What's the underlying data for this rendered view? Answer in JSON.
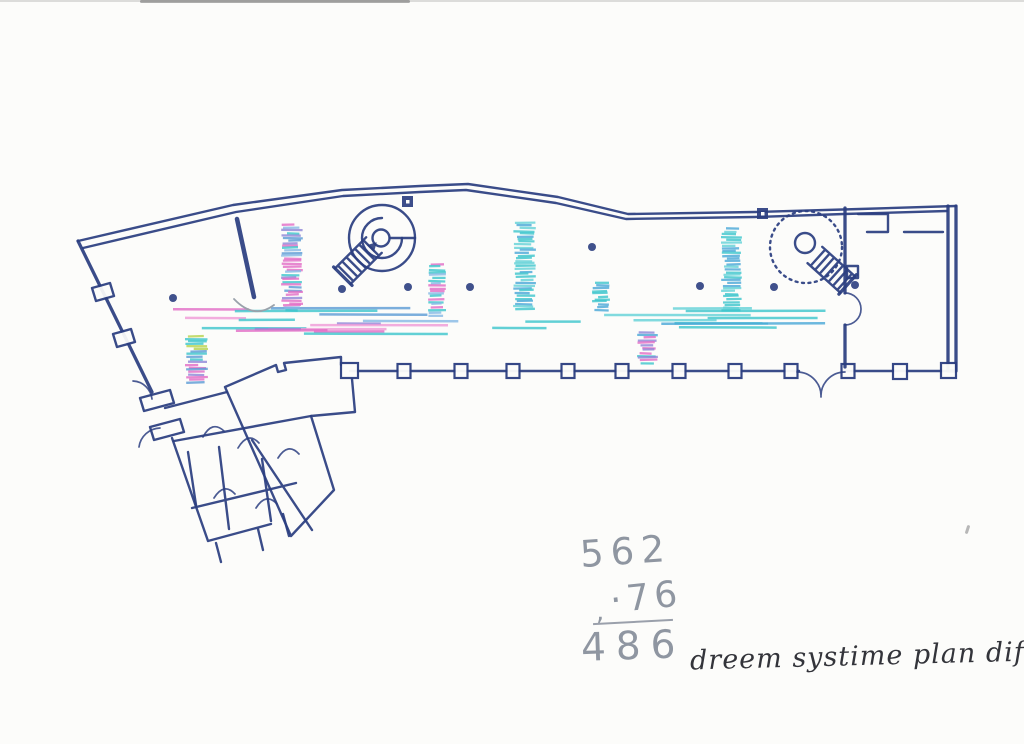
{
  "page": {
    "background": "#fcfcfa"
  },
  "annotations": {
    "calculation": {
      "minuend": "562",
      "subtrahend_mark": ",",
      "subtrahend": "·76",
      "result": "486"
    },
    "note": "dreem systime plan dif,"
  },
  "plan": {
    "ink_color": "#2b3e80",
    "pencil_color": "#9aa2ab",
    "marker_palette_names": [
      "pink",
      "light-pink",
      "blue",
      "light-blue",
      "steel-blue",
      "cyan",
      "light-cyan",
      "violet",
      "green"
    ],
    "bands": [
      {
        "id": "hall-band-left",
        "x": 146,
        "y": 309,
        "w": 320,
        "h": 27,
        "step": 2.8,
        "density": 2.4,
        "lmin": 40,
        "lmax": 160,
        "palette": [
          "#e26cc6",
          "#f09ad8",
          "#5b9bd5",
          "#86b9e6",
          "#3cc6cd",
          "#8f86d8",
          "#e26cc6",
          "#5b9bd5"
        ]
      },
      {
        "id": "hall-band-right",
        "x": 466,
        "y": 308,
        "w": 367,
        "h": 21,
        "step": 3.2,
        "density": 1.7,
        "lmin": 50,
        "lmax": 180,
        "palette": [
          "#3cc6cd",
          "#63d2d8",
          "#49a8d8",
          "#3cc6cd",
          "#3cc6cd"
        ]
      },
      {
        "id": "pier-band-1",
        "x": 281,
        "y": 225,
        "w": 22,
        "h": 87,
        "step": 2.6,
        "density": 1,
        "lmin": 0,
        "lmax": 0,
        "palette": [
          "#e26cc6",
          "#5b9bd5",
          "#3cc6cd",
          "#8f86d8",
          "#e26cc6",
          "#86b9e6"
        ]
      },
      {
        "id": "pier-band-2",
        "x": 428,
        "y": 264,
        "w": 18,
        "h": 53,
        "step": 2.7,
        "density": 1,
        "lmin": 0,
        "lmax": 0,
        "palette": [
          "#3cc6cd",
          "#e26cc6",
          "#86b9e6",
          "#3cc6cd"
        ]
      },
      {
        "id": "pier-band-3",
        "x": 513,
        "y": 223,
        "w": 23,
        "h": 89,
        "step": 2.7,
        "density": 1,
        "lmin": 0,
        "lmax": 0,
        "palette": [
          "#3cc6cd",
          "#49a8d8",
          "#63d2d8"
        ]
      },
      {
        "id": "pier-band-4",
        "x": 592,
        "y": 283,
        "w": 18,
        "h": 28,
        "step": 2.7,
        "density": 1,
        "lmin": 0,
        "lmax": 0,
        "palette": [
          "#3cc6cd",
          "#49a8d8"
        ]
      },
      {
        "id": "pier-band-5",
        "x": 721,
        "y": 229,
        "w": 21,
        "h": 82,
        "step": 2.7,
        "density": 1,
        "lmin": 0,
        "lmax": 0,
        "palette": [
          "#3cc6cd",
          "#49a8d8",
          "#63d2d8"
        ]
      },
      {
        "id": "pier-band-6",
        "x": 185,
        "y": 336,
        "w": 23,
        "h": 49,
        "step": 2.6,
        "density": 1,
        "lmin": 0,
        "lmax": 0,
        "palette": [
          "#e26cc6",
          "#5b9bd5",
          "#3cc6cd",
          "#8f86d8",
          "#b7d44e",
          "#e26cc6"
        ]
      },
      {
        "id": "pier-band-7",
        "x": 637,
        "y": 332,
        "w": 21,
        "h": 33,
        "step": 2.6,
        "density": 1,
        "lmin": 0,
        "lmax": 0,
        "palette": [
          "#e26cc6",
          "#3cc6cd",
          "#49a8d8",
          "#8f86d8"
        ]
      }
    ],
    "column_dots": [
      [
        173,
        298
      ],
      [
        342,
        289
      ],
      [
        408,
        287
      ],
      [
        470,
        287
      ],
      [
        592,
        247
      ],
      [
        700,
        286
      ],
      [
        774,
        287
      ],
      [
        855,
        285
      ]
    ],
    "stair_markers": [
      [
        402,
        196
      ],
      [
        757,
        208
      ]
    ]
  }
}
